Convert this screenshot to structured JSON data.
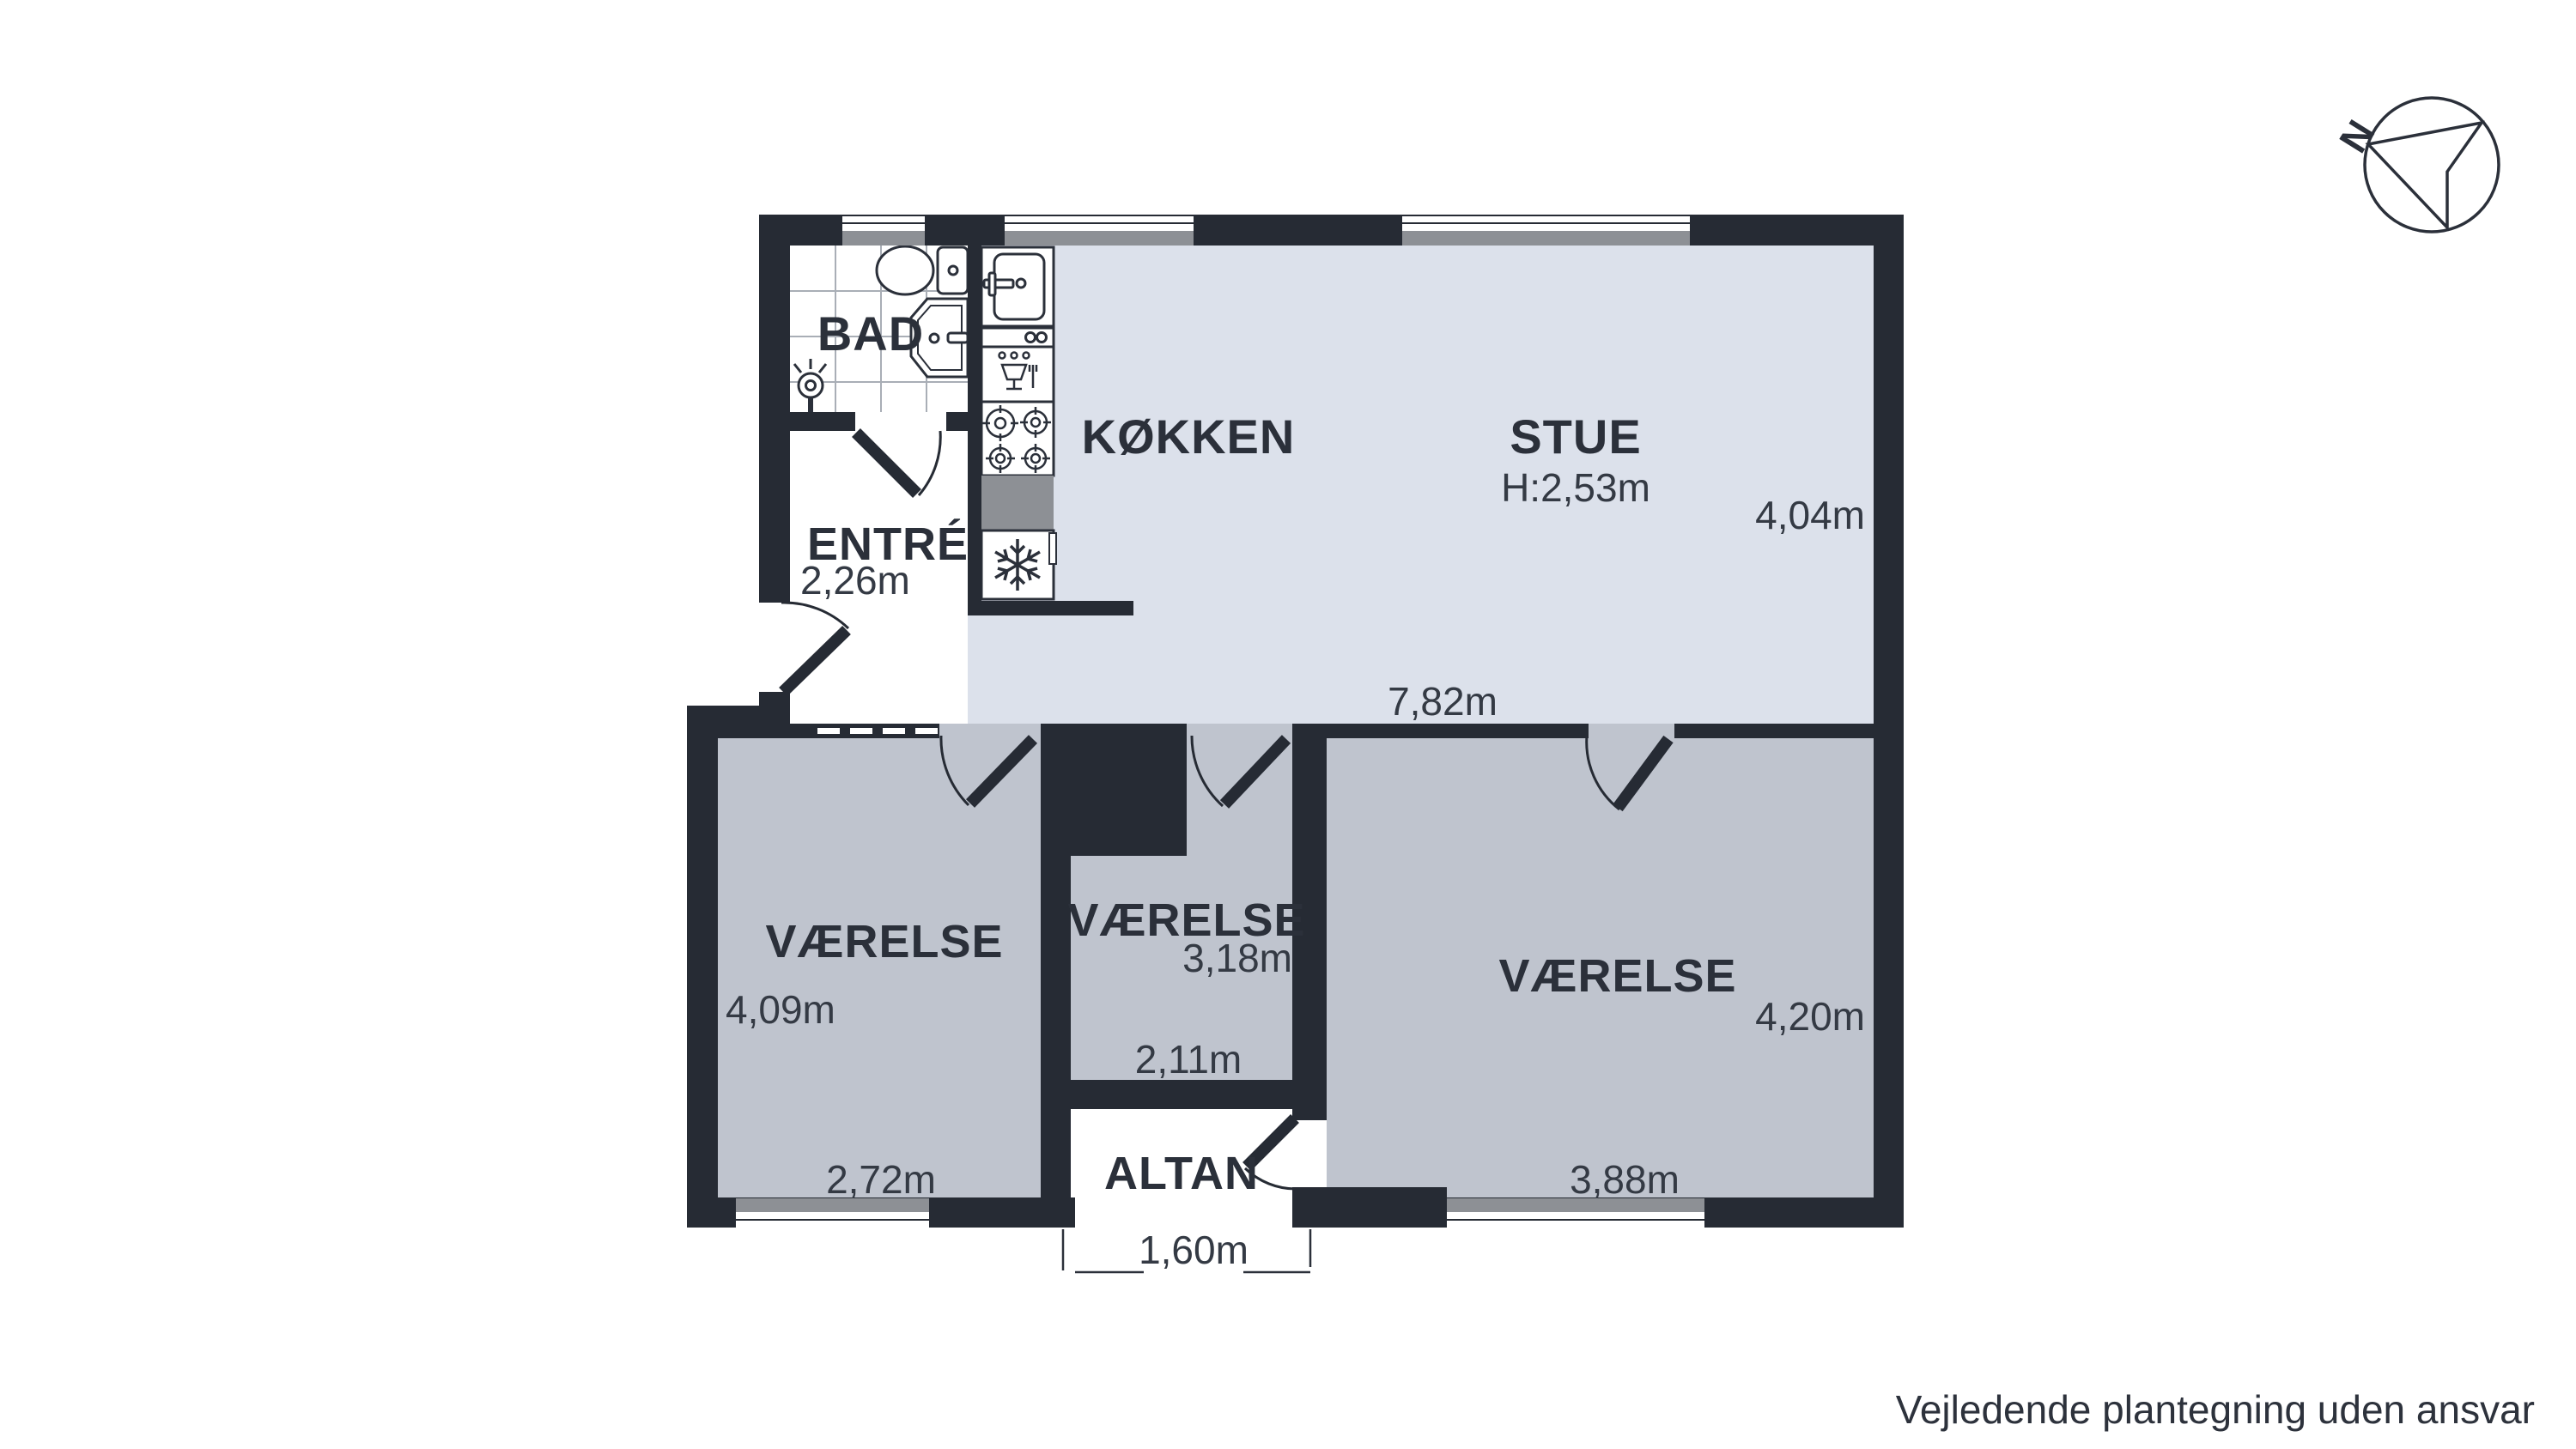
{
  "title": "Plantegning",
  "compass": {
    "label": "N"
  },
  "disclaimer": "Vejledende plantegning uden ansvar",
  "rooms": {
    "bad": {
      "name": "BAD"
    },
    "entre": {
      "name": "ENTRÉ",
      "width": "2,26m"
    },
    "kokken": {
      "name": "KØKKEN"
    },
    "stue": {
      "name": "STUE",
      "ceiling_height": "H:2,53m",
      "depth": "4,04m",
      "width": "7,82m"
    },
    "vaerelse_left": {
      "name": "VÆRELSE",
      "depth": "4,09m",
      "width": "2,72m"
    },
    "vaerelse_mid": {
      "name": "VÆRELSE",
      "depth": "3,18m",
      "width": "2,11m"
    },
    "vaerelse_right": {
      "name": "VÆRELSE",
      "depth": "4,20m",
      "width": "3,88m"
    },
    "altan": {
      "name": "ALTAN",
      "width": "1,60m"
    }
  },
  "colors": {
    "wall": "#262b34",
    "floor_living": "#dce1eb",
    "floor_bedroom": "#bfc4ce",
    "floor_white": "#ffffff",
    "counter_gray": "#8d9095",
    "tile_line": "#a9aeb6",
    "text": "#2b303a"
  },
  "icons": [
    "compass-icon",
    "toilet-icon",
    "bathroom-sink-icon",
    "shower-icon",
    "kitchen-sink-icon",
    "dishwasher-icon",
    "stove-icon",
    "fridge-icon",
    "snowflake-icon"
  ]
}
